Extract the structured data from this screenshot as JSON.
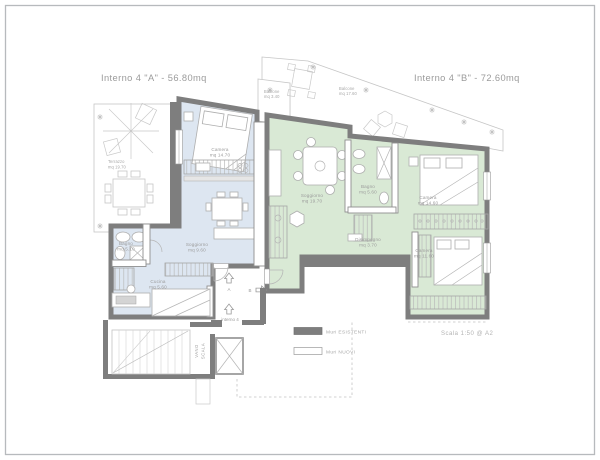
{
  "page": {
    "title_a": "Interno 4 \"A\" - 56.80mq",
    "title_b": "Interno 4 \"B\" - 72.60mq",
    "scale_note": "Scala 1:50 @ A2"
  },
  "legend": {
    "existing_walls_label": "Muri ESISTENTI",
    "new_walls_label": "Muri NUOVI"
  },
  "colors": {
    "apartment_a_fill": "#dde6f1",
    "apartment_b_fill": "#d9e9d5",
    "existing_wall": "#7e7e7e",
    "new_wall_fill": "#ffffff",
    "annotation_text": "#9b9b9b"
  },
  "apartment_a": {
    "rooms": {
      "terrazzo": {
        "name": "Terrazzo",
        "area": "mq 19.70"
      },
      "camera": {
        "name": "Camera",
        "area": "mq 14.70"
      },
      "soggiorno": {
        "name": "Soggiorno",
        "area": "mq 9.60"
      },
      "bagno": {
        "name": "Bagno",
        "area": "mq 5.10"
      },
      "cucina": {
        "name": "Cucina",
        "area": "mq 5.60"
      }
    }
  },
  "apartment_b": {
    "rooms": {
      "balcone_piccolo": {
        "name": "Balcone",
        "area": "mq 3.40"
      },
      "balcone_grande": {
        "name": "Balcone",
        "area": "mq 17.60"
      },
      "soggiorno": {
        "name": "Soggiorno",
        "area": "mq 19.70"
      },
      "bagno": {
        "name": "Bagno",
        "area": "mq 5.60"
      },
      "camera_1": {
        "name": "Camera",
        "area": "mq 14.60"
      },
      "disimpegno": {
        "name": "Disimpegno",
        "area": "mq 3.70"
      },
      "camera_2": {
        "name": "Camera",
        "area": "mq 11.60"
      }
    }
  },
  "annotations": {
    "entrance_label": "interno 4",
    "entrance_a": "A",
    "entrance_b": "B",
    "stairwell_word_1": "VANO",
    "stairwell_word_2": "SCALA"
  }
}
